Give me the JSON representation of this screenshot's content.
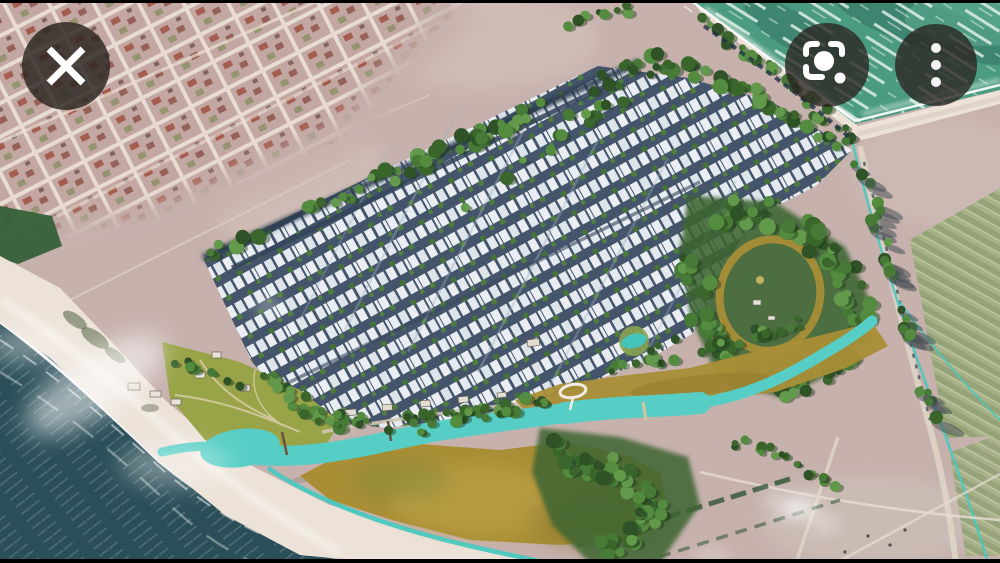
{
  "app": {
    "name": "image viewer",
    "screen": "photo preview overlay"
  },
  "toolbar": {
    "close_button": {
      "label": "Close",
      "icon": "close-x-icon"
    },
    "lens_button": {
      "label": "Search with Google Lens",
      "icon": "google-lens-icon"
    },
    "more_button": {
      "label": "More options",
      "icon": "three-dot-menu-icon"
    }
  },
  "image": {
    "type": "aerial-render",
    "subject": "Coastal master-planned housing development with turquoise lagoon, forest reserve, golden meadows and white beach, beside an existing town grid and cleared fields",
    "regions": [
      "existing-town-grid",
      "cleared-land",
      "housing-rows",
      "tree-lined-boulevards",
      "forest-reserve",
      "loop-trail",
      "turquoise-lagoon",
      "boat-canal",
      "golden-meadow",
      "waterfront-park",
      "white-sand-beach",
      "dark-ocean",
      "sea-with-surf",
      "perimeter-road",
      "farm-fields"
    ]
  },
  "scene_colors": {
    "field": "#c6b1ad",
    "town": "#c3a7a2",
    "town_road": "#e9ded4",
    "ocean": "#2b4e58",
    "ocean_ripple": "#587880",
    "beach": "#ece2d8",
    "sea": "#4b9a82",
    "sea_foam": "#e9f4eb",
    "street": "#44546a",
    "house": "#eaeef2",
    "tree": "#4a7c38",
    "forest": "#3c6530",
    "lagoon": "#57cec5",
    "canal": "#49c8bf",
    "meadow": "#a98e36",
    "park": "#99a348",
    "road_light": "#ded3c7",
    "shadow": "#3f4a50"
  }
}
